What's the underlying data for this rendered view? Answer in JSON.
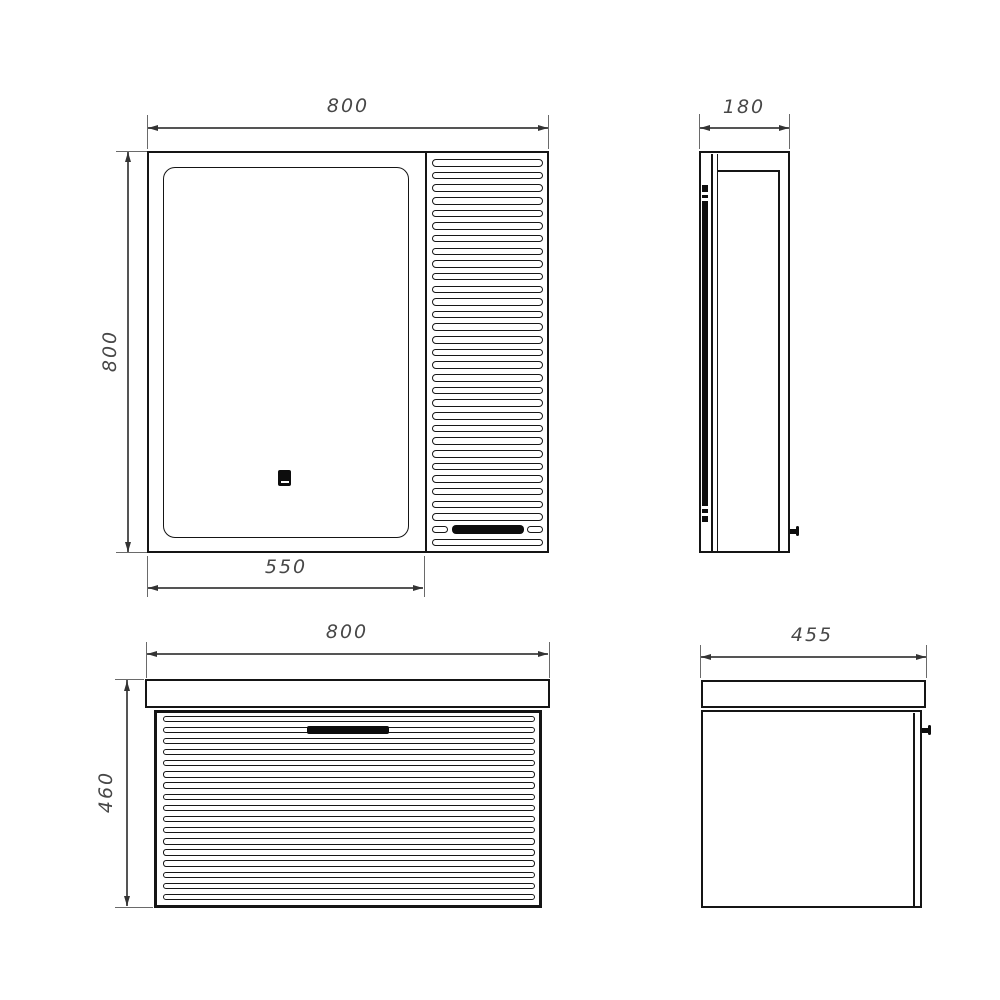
{
  "drawing": {
    "views": {
      "cabinet_front": {
        "width_label": "800",
        "height_label": "800",
        "door_width_label": "550",
        "louver_slat_count": 31,
        "louver_handle_row_index": 29
      },
      "cabinet_side": {
        "depth_label": "180"
      },
      "vanity_front": {
        "width_label": "800",
        "height_label": "460",
        "drawer_slat_count": 17
      },
      "vanity_side": {
        "depth_label": "455"
      }
    },
    "icons": {
      "touch_sensor": "touch-sensor-icon",
      "cabinet_door_knob": "door-knob-icon",
      "vanity_door_knob": "door-knob-icon",
      "cabinet_handle": "handle-bar-icon",
      "drawer_handle": "handle-bar-icon"
    },
    "colors": {
      "background": "#ffffff",
      "object_line": "#151515",
      "dimension_line": "#555555",
      "dimension_text": "#474747",
      "handle_fill": "#0d0d0d"
    }
  }
}
